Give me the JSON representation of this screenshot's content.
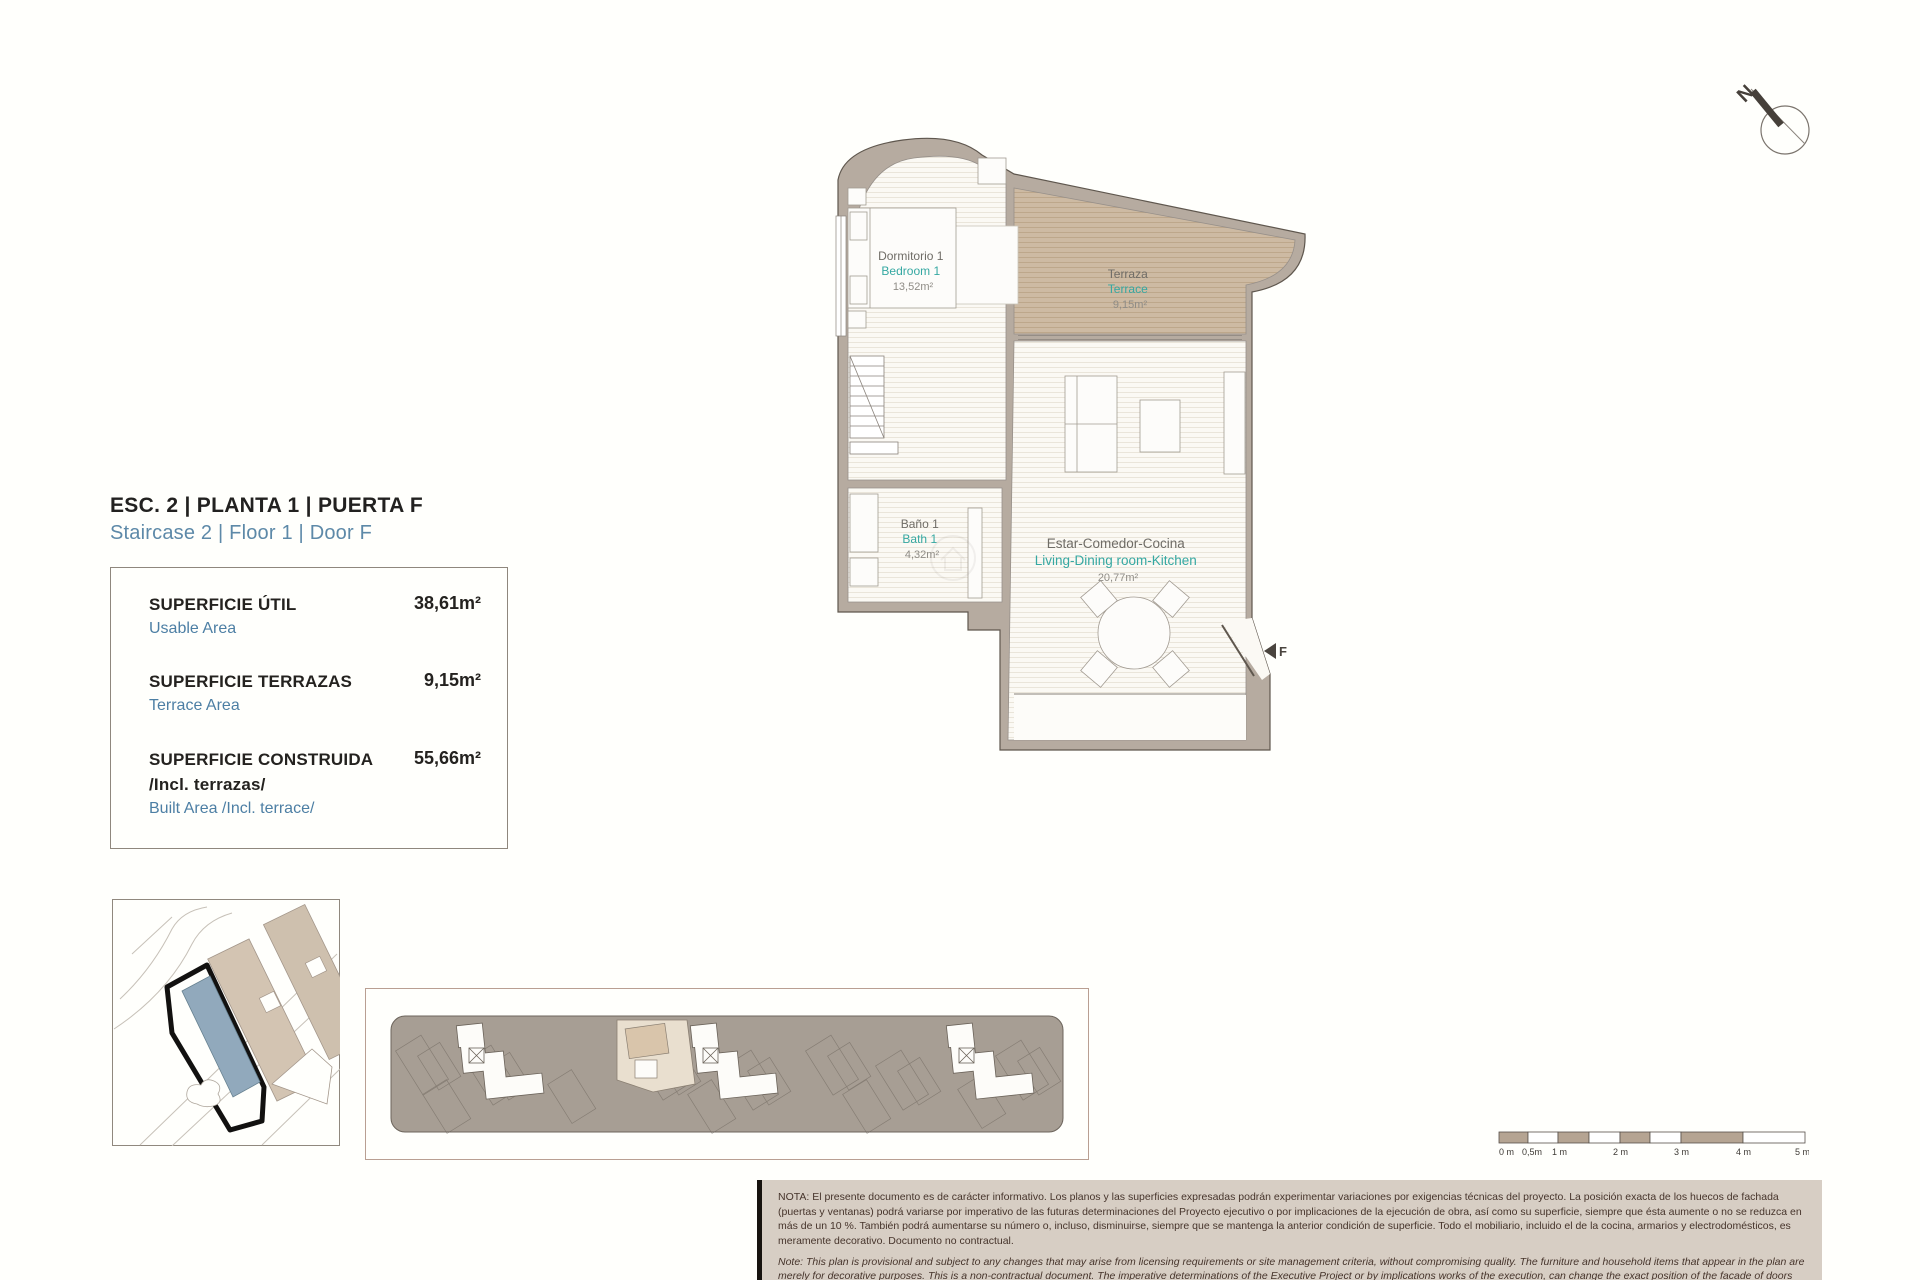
{
  "title": {
    "es": "ESC. 2 | PLANTA 1 | PUERTA F",
    "en": "Staircase 2 | Floor 1 | Door F"
  },
  "areas_box": {
    "usable": {
      "label_es": "SUPERFICIE ÚTIL",
      "label_en": "Usable Area",
      "value": "38,61m²"
    },
    "terrace": {
      "label_es": "SUPERFICIE TERRAZAS",
      "label_en": "Terrace Area",
      "value": "9,15m²"
    },
    "built": {
      "label_es": "SUPERFICIE CONSTRUIDA",
      "label_es2": "/Incl. terrazas/",
      "label_en": "Built Area /Incl. terrace/",
      "value": "55,66m²"
    }
  },
  "plan": {
    "rooms": [
      {
        "name_es": "Dormitorio 1",
        "name_en": "Bedroom 1",
        "area": "13,52m²"
      },
      {
        "name_es": "Terraza",
        "name_en": "Terrace",
        "area": "9,15m²"
      },
      {
        "name_es": "Baño 1",
        "name_en": "Bath 1",
        "area": "4,32m²"
      },
      {
        "name_es": "Estar-Comedor-Cocina",
        "name_en": "Living-Dining room-Kitchen",
        "area": "20,77m²"
      }
    ],
    "door_label": "F",
    "compass_label": "N"
  },
  "scale_bar": {
    "labels": [
      "0 m",
      "0,5m",
      "1 m",
      "2 m",
      "3 m",
      "4 m",
      "5 m"
    ]
  },
  "notes": {
    "es": "NOTA:  El presente documento es de carácter informativo. Los planos y las superficies expresadas podrán experimentar variaciones por exigencias técnicas del proyecto. La posición exacta de los huecos de fachada (puertas y ventanas) podrá variarse por imperativo de las futuras determinaciones del Proyecto ejecutivo o por implicaciones de la ejecución de obra, así como su superficie, siempre que ésta aumente o no se reduzca en más de un 10 %. También podrá aumentarse su número o, incluso, disminuirse, siempre que se mantenga la anterior condición de superficie. Todo el mobiliario, incluido el de la cocina, armarios y electrodomésticos, es meramente decorativo. Documento no contractual.",
    "en": "Note: This plan is provisional and subject to any changes that may arise from licensing requirements or site management criteria, without compromising quality. The furniture and household items that appear in the plan are merely for decorative purposes. This is a non-contractual document. The imperative determinations of the Executive Project or by implications works of the execution, can change the exact position of the facade of doors and windows, as well the surface area may also be increased or even decrease not more than a 10%.",
    "version": "V.1_JUN-25"
  },
  "colors": {
    "wall": "#b6aba0",
    "terrace_fill": "#cdbaa3",
    "accent_teal": "#35a8a2",
    "accent_blue": "#5d89a8",
    "site_highlight": "#91a9bc",
    "note_bg": "#d7cec4"
  }
}
